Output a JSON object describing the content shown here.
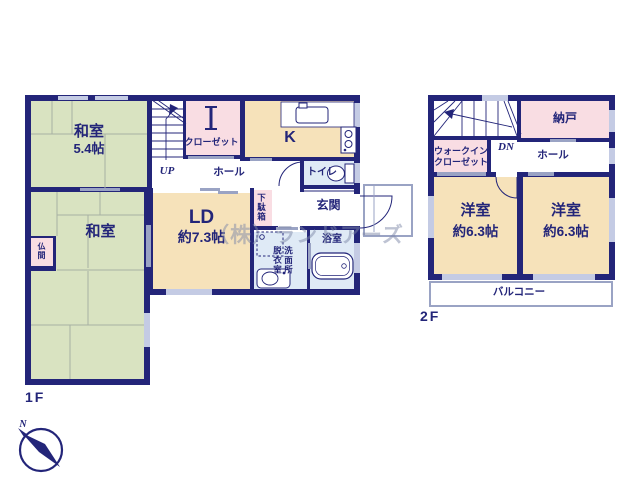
{
  "watermark": "（株）ランドアーズ",
  "compass": {
    "n": "N"
  },
  "floor1": {
    "label": "1F",
    "washitsu1_name": "和室",
    "washitsu1_size": "5.4帖",
    "up": "UP",
    "closet": "クローゼット",
    "kitchen": "K",
    "hall": "ホール",
    "toilet": "トイレ",
    "genkan": "玄関",
    "getabako": "下駄箱",
    "ld_name": "LD",
    "ld_size": "約7.3帖",
    "washitsu2_name": "和室",
    "butsuma": "仏間",
    "datsui": "脱衣室",
    "senmen": "洗面所",
    "bath": "浴室"
  },
  "floor2": {
    "label": "2F",
    "dn": "DN",
    "wic_line1": "ウォークイン",
    "wic_line2": "クローゼット",
    "nando": "納戸",
    "hall": "ホール",
    "west_room_left_name": "洋室",
    "west_room_left_size": "約6.3帖",
    "west_room_right_name": "洋室",
    "west_room_right_size": "約6.3帖",
    "balcony": "バルコニー"
  },
  "colors": {
    "wall": "#232579",
    "tatami_green": "#d9e3c1",
    "wood_cream": "#f6e2ba",
    "storage_pink": "#f9dde3",
    "sanitary_blue": "#dfeaf6",
    "line_gray": "#9aa3c4"
  }
}
